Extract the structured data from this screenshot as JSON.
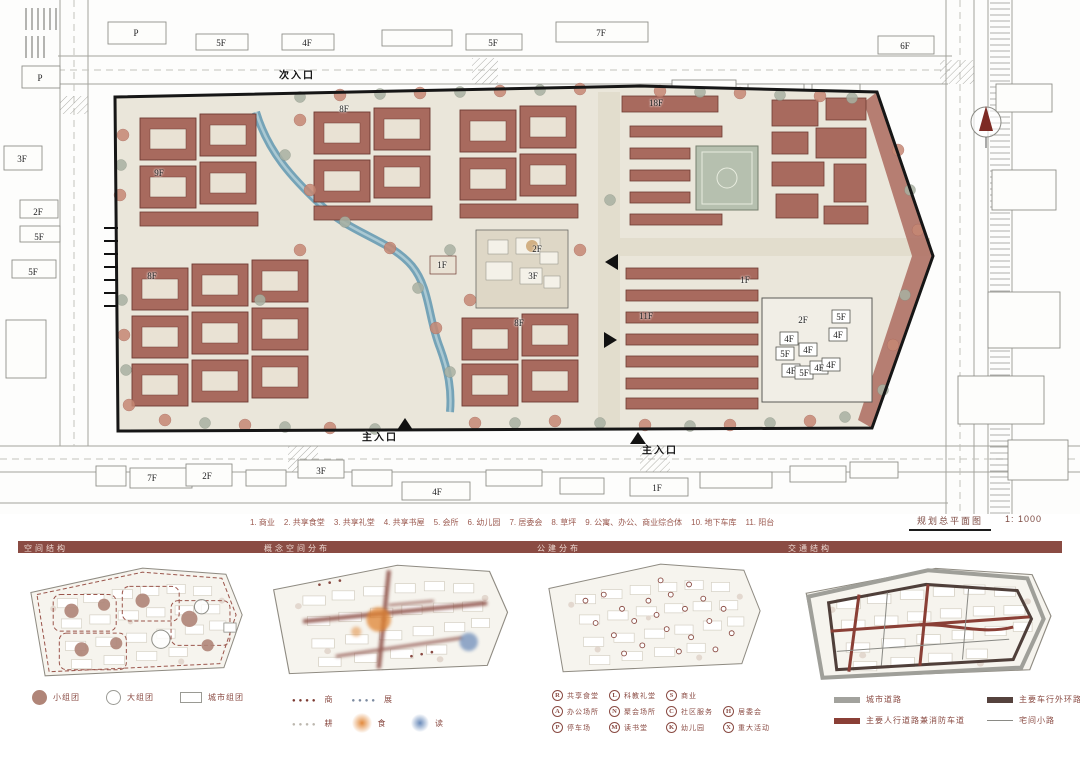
{
  "colors": {
    "header_bar": "#8a4b43",
    "building_terracotta": "#a86a5e",
    "river_blue": "#6f9fb5",
    "accent_red": "#8a3f36",
    "legend_text": "#8a4b43",
    "caption_text": "#9b5a50"
  },
  "master_plan": {
    "title": "规划总平面图",
    "scale": "1: 1000",
    "caption_items": [
      "1. 商业",
      "2. 共享食堂",
      "3. 共享礼堂",
      "4. 共享书屋",
      "5. 会所",
      "6. 幼儿园",
      "7. 居委会",
      "8. 草坪",
      "9. 公寓、办公、商业综合体",
      "10. 地下车库",
      "11. 阳台"
    ],
    "floor_labels": [
      {
        "t": "P",
        "x": 136,
        "y": 33
      },
      {
        "t": "5F",
        "x": 221,
        "y": 43
      },
      {
        "t": "4F",
        "x": 307,
        "y": 43
      },
      {
        "t": "5F",
        "x": 493,
        "y": 43
      },
      {
        "t": "7F",
        "x": 601,
        "y": 33
      },
      {
        "t": "6F",
        "x": 905,
        "y": 46
      },
      {
        "t": "P",
        "x": 40,
        "y": 78
      },
      {
        "t": "3F",
        "x": 22,
        "y": 159
      },
      {
        "t": "2F",
        "x": 38,
        "y": 212
      },
      {
        "t": "5F",
        "x": 39,
        "y": 237
      },
      {
        "t": "5F",
        "x": 33,
        "y": 272
      },
      {
        "t": "7F",
        "x": 152,
        "y": 478
      },
      {
        "t": "2F",
        "x": 207,
        "y": 476
      },
      {
        "t": "3F",
        "x": 321,
        "y": 471
      },
      {
        "t": "4F",
        "x": 437,
        "y": 492
      },
      {
        "t": "1F",
        "x": 657,
        "y": 488
      },
      {
        "t": "9F",
        "x": 159,
        "y": 173
      },
      {
        "t": "8F",
        "x": 344,
        "y": 109
      },
      {
        "t": "8F",
        "x": 152,
        "y": 276
      },
      {
        "t": "18F",
        "x": 656,
        "y": 103
      },
      {
        "t": "11F",
        "x": 646,
        "y": 316
      },
      {
        "t": "2F",
        "x": 537,
        "y": 249
      },
      {
        "t": "3F",
        "x": 533,
        "y": 276
      },
      {
        "t": "1F",
        "x": 442,
        "y": 265
      },
      {
        "t": "1F",
        "x": 745,
        "y": 280
      },
      {
        "t": "8F",
        "x": 519,
        "y": 323
      },
      {
        "t": "2F",
        "x": 803,
        "y": 320
      },
      {
        "t": "5F",
        "x": 841,
        "y": 317
      },
      {
        "t": "4F",
        "x": 838,
        "y": 335
      },
      {
        "t": "4F",
        "x": 789,
        "y": 339
      },
      {
        "t": "4F",
        "x": 808,
        "y": 350
      },
      {
        "t": "5F",
        "x": 785,
        "y": 354
      },
      {
        "t": "4F",
        "x": 791,
        "y": 371
      },
      {
        "t": "5F",
        "x": 804,
        "y": 373
      },
      {
        "t": "4F",
        "x": 819,
        "y": 368
      },
      {
        "t": "4F",
        "x": 831,
        "y": 365
      }
    ],
    "entrances": [
      {
        "t": "次入口",
        "x": 297,
        "y": 74
      },
      {
        "t": "主入口",
        "x": 380,
        "y": 436
      },
      {
        "t": "主入口",
        "x": 660,
        "y": 449
      }
    ]
  },
  "sections": [
    {
      "title": "空间结构",
      "legend": [
        {
          "cls": "sw-circle-filled",
          "label": "小组团"
        },
        {
          "cls": "sw-circle-outline",
          "label": "大组团"
        },
        {
          "cls": "sw-rect-outline",
          "label": "城市组团"
        }
      ]
    },
    {
      "title": "概念空间分布",
      "legend": [
        {
          "cls": "sw-dots-red",
          "label": "商"
        },
        {
          "cls": "sw-dots-steel",
          "label": "展"
        },
        {
          "cls": "blank",
          "label": ""
        },
        {
          "cls": "sw-dots-light",
          "label": "耕"
        },
        {
          "cls": "sw-blob-orange",
          "label": "食"
        },
        {
          "cls": "sw-blob-blue",
          "label": "读"
        }
      ]
    },
    {
      "title": "公建分布",
      "legend": [
        {
          "letter": "R",
          "label": "共享食堂"
        },
        {
          "letter": "A",
          "label": "办公场所"
        },
        {
          "letter": "P",
          "label": "停车场"
        },
        {
          "letter": "L",
          "label": "科教礼堂"
        },
        {
          "letter": "N",
          "label": "聚会场所"
        },
        {
          "letter": "M",
          "label": "读书堂"
        },
        {
          "letter": "S",
          "label": "商业"
        },
        {
          "letter": "C",
          "label": "社区服务"
        },
        {
          "letter": "K",
          "label": "幼儿园"
        },
        {
          "cls": "blank",
          "letter": "",
          "label": ""
        },
        {
          "letter": "H",
          "label": "居委会"
        },
        {
          "letter": "X",
          "label": "重大活动"
        }
      ]
    },
    {
      "title": "交通结构",
      "legend": [
        {
          "cls": "sw-bar-gray",
          "label": "城市道路"
        },
        {
          "cls": "sw-bar-dark",
          "label": "主要车行外环路"
        },
        {
          "cls": "sw-bar-red",
          "label": "主要人行道路兼消防车道"
        },
        {
          "cls": "sw-line-thin",
          "label": "宅间小路"
        }
      ]
    }
  ]
}
